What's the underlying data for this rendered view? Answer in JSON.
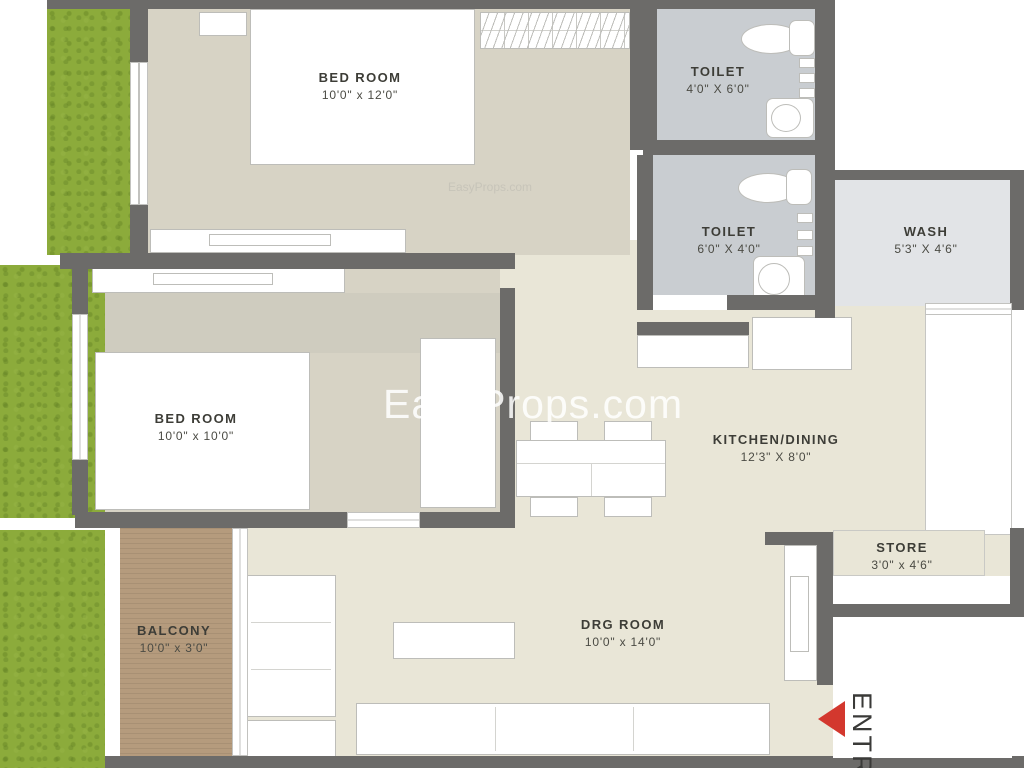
{
  "watermark": {
    "text": "EasyProps.com",
    "ghost_text": "EasyProps.com"
  },
  "rooms": [
    {
      "id": "bedroom1",
      "name": "BED ROOM",
      "dims": "10'0\" x 12'0\""
    },
    {
      "id": "toilet1",
      "name": "TOILET",
      "dims": "4'0\" X 6'0\""
    },
    {
      "id": "toilet2",
      "name": "TOILET",
      "dims": "6'0\" X 4'0\""
    },
    {
      "id": "wash",
      "name": "WASH",
      "dims": "5'3\" X 4'6\""
    },
    {
      "id": "bedroom2",
      "name": "BED ROOM",
      "dims": "10'0\" x 10'0\""
    },
    {
      "id": "kitchen",
      "name": "KITCHEN/DINING",
      "dims": "12'3\" X 8'0\""
    },
    {
      "id": "store",
      "name": "STORE",
      "dims": "3'0\" x 4'6\""
    },
    {
      "id": "balcony",
      "name": "BALCONY",
      "dims": "10'0\" x 3'0\""
    },
    {
      "id": "drg",
      "name": "DRG ROOM",
      "dims": "10'0\" x 14'0\""
    }
  ],
  "entry": {
    "label": "ENTRY"
  },
  "colors": {
    "wall": "#6c6b69",
    "bedroom_floor": "#d7d3c5",
    "living_floor": "#e9e6d7",
    "toilet_floor": "#c9cdd1",
    "wash_floor": "#e2e4e7",
    "balcony_floor": "#b59b7d",
    "grass": "#8cab3b",
    "entry_arrow": "#d3382e",
    "label_text": "#3d3d37"
  }
}
